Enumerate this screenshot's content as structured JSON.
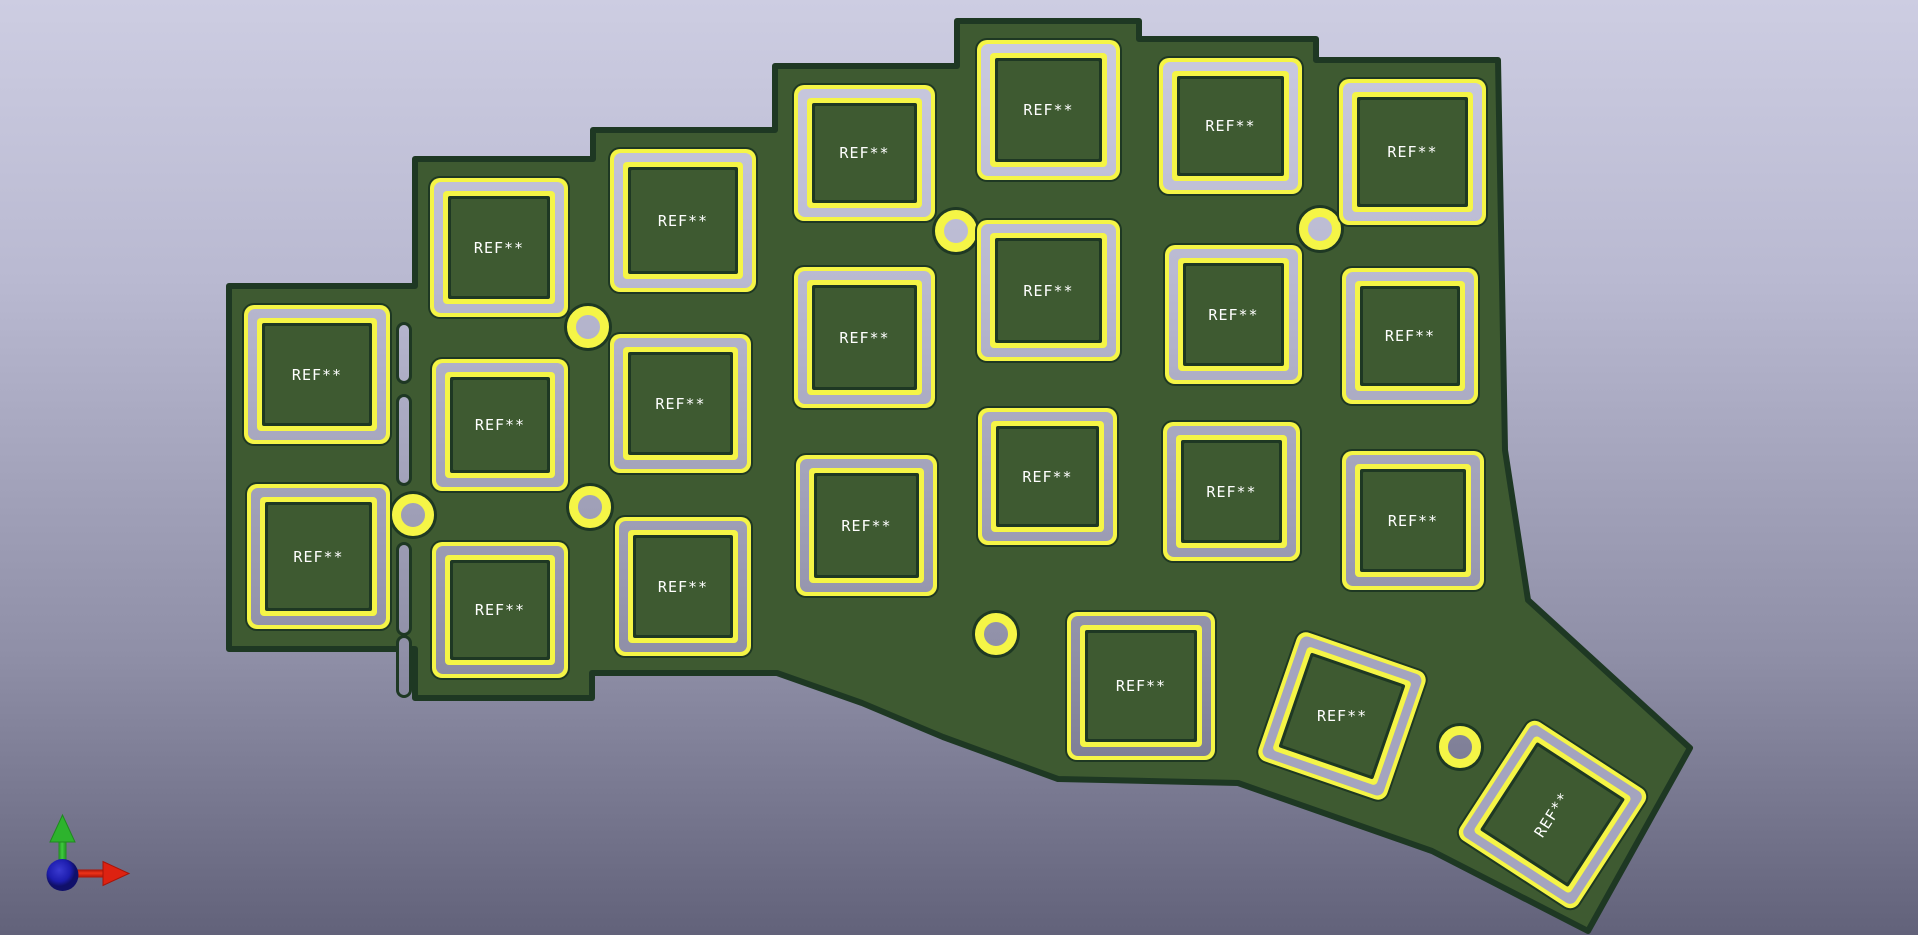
{
  "viewer": {
    "description": "3D PCB viewer viewport",
    "board_kind": "ergonomic split keyboard half with switch pad footprints"
  },
  "colors": {
    "background_top": "#cdcde2",
    "background_bottom": "#62627a",
    "board_green": "#3e5a31",
    "board_edge_dark": "#1e3823",
    "silkscreen_yellow": "#f5f546",
    "pad_silver": "#b9b9d1",
    "ref_text": "#ffffff",
    "axis_x_red": "#dd2211",
    "axis_y_green": "#2db32d",
    "axis_z_blue": "#1d1dae"
  },
  "board": {
    "outline_path": "M 229 286 L 415 286 L 415 159 L 593 159 L 593 130 L 775 130 L 775 66 L 957 66 L 957 21 L 1139 21 L 1139 39 L 1316 39 L 1316 60 L 1498 60 L 1505 450 L 1528 600 L 1690 748 L 1588 931 L 1432 851 L 1238 783 L 1058 779 L 943 737 L 862 703 L 777 673 L 592 673 L 592 698 L 415 698 L 415 649 L 229 649 Z"
  },
  "footprints": [
    {
      "label": "REF**",
      "x": 242,
      "y": 303,
      "w": 150,
      "h": 143,
      "rot": 0,
      "label_rot": 0
    },
    {
      "label": "REF**",
      "x": 245,
      "y": 482,
      "w": 147,
      "h": 149,
      "rot": 0,
      "label_rot": 0
    },
    {
      "label": "REF**",
      "x": 428,
      "y": 176,
      "w": 142,
      "h": 143,
      "rot": 0,
      "label_rot": 0
    },
    {
      "label": "REF**",
      "x": 430,
      "y": 357,
      "w": 140,
      "h": 136,
      "rot": 0,
      "label_rot": 0
    },
    {
      "label": "REF**",
      "x": 430,
      "y": 540,
      "w": 140,
      "h": 140,
      "rot": 0,
      "label_rot": 0
    },
    {
      "label": "REF**",
      "x": 608,
      "y": 147,
      "w": 150,
      "h": 147,
      "rot": 0,
      "label_rot": 0
    },
    {
      "label": "REF**",
      "x": 608,
      "y": 332,
      "w": 145,
      "h": 143,
      "rot": 0,
      "label_rot": 0
    },
    {
      "label": "REF**",
      "x": 613,
      "y": 515,
      "w": 140,
      "h": 143,
      "rot": 0,
      "label_rot": 0
    },
    {
      "label": "REF**",
      "x": 792,
      "y": 83,
      "w": 145,
      "h": 140,
      "rot": 0,
      "label_rot": 0
    },
    {
      "label": "REF**",
      "x": 792,
      "y": 265,
      "w": 145,
      "h": 145,
      "rot": 0,
      "label_rot": 0
    },
    {
      "label": "REF**",
      "x": 794,
      "y": 453,
      "w": 145,
      "h": 145,
      "rot": 0,
      "label_rot": 0
    },
    {
      "label": "REF**",
      "x": 975,
      "y": 38,
      "w": 147,
      "h": 144,
      "rot": 0,
      "label_rot": 0
    },
    {
      "label": "REF**",
      "x": 975,
      "y": 218,
      "w": 147,
      "h": 145,
      "rot": 0,
      "label_rot": 0
    },
    {
      "label": "REF**",
      "x": 976,
      "y": 406,
      "w": 143,
      "h": 141,
      "rot": 0,
      "label_rot": 0
    },
    {
      "label": "REF**",
      "x": 1157,
      "y": 56,
      "w": 147,
      "h": 140,
      "rot": 0,
      "label_rot": 0
    },
    {
      "label": "REF**",
      "x": 1163,
      "y": 243,
      "w": 141,
      "h": 143,
      "rot": 0,
      "label_rot": 0
    },
    {
      "label": "REF**",
      "x": 1161,
      "y": 420,
      "w": 141,
      "h": 143,
      "rot": 0,
      "label_rot": 0
    },
    {
      "label": "REF**",
      "x": 1337,
      "y": 77,
      "w": 151,
      "h": 150,
      "rot": 0,
      "label_rot": 0
    },
    {
      "label": "REF**",
      "x": 1340,
      "y": 266,
      "w": 140,
      "h": 140,
      "rot": 0,
      "label_rot": 0
    },
    {
      "label": "REF**",
      "x": 1340,
      "y": 449,
      "w": 146,
      "h": 143,
      "rot": 0,
      "label_rot": 0
    },
    {
      "label": "REF**",
      "x": 1065,
      "y": 610,
      "w": 152,
      "h": 152,
      "rot": 0,
      "label_rot": 0
    },
    {
      "label": "REF**",
      "x": 1272,
      "y": 646,
      "w": 140,
      "h": 140,
      "rot": 19,
      "label_rot": -19
    },
    {
      "label": "REF**",
      "x": 1480,
      "y": 742,
      "w": 145,
      "h": 145,
      "rot": 33,
      "label_rot": -90
    }
  ],
  "holes": [
    {
      "cx": 413,
      "cy": 515
    },
    {
      "cx": 588,
      "cy": 327
    },
    {
      "cx": 590,
      "cy": 507
    },
    {
      "cx": 956,
      "cy": 231
    },
    {
      "cx": 1320,
      "cy": 229
    },
    {
      "cx": 996,
      "cy": 634
    },
    {
      "cx": 1460,
      "cy": 747
    }
  ],
  "slots": [
    {
      "x": 399,
      "y": 325,
      "h": 56
    },
    {
      "x": 399,
      "y": 397,
      "h": 86
    },
    {
      "x": 399,
      "y": 545,
      "h": 88
    },
    {
      "x": 399,
      "y": 638,
      "h": 57
    }
  ],
  "axis_gizmo": {
    "x_axis": "X (red, right)",
    "y_axis": "Y (green, up)",
    "z_axis": "Z (blue, toward viewer)"
  }
}
